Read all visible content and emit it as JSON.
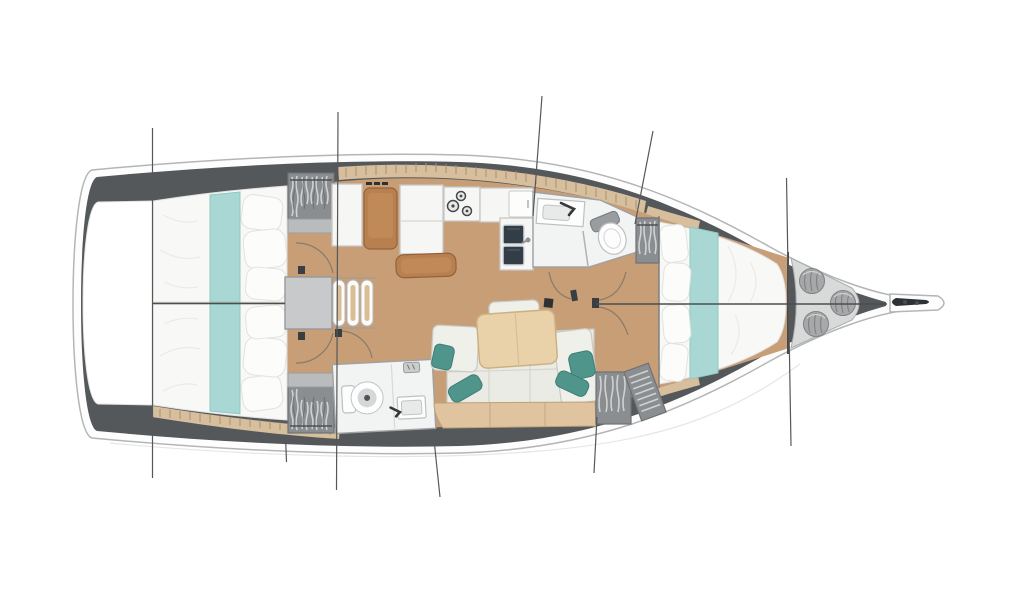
{
  "diagram": {
    "type": "yacht-interior-floor-plan",
    "orientation": "bow-right",
    "components": [
      "hull",
      "transom-platform",
      "bulwark-band",
      "deck-tick-strip",
      "aft-cabin-port",
      "aft-cabin-starboard",
      "double-berth",
      "teal-bed-runner",
      "hanging-wardrobe",
      "companionway-steps",
      "engine-box",
      "galley-cabinet",
      "nav-seat",
      "chart-table",
      "stove-burners",
      "double-sink",
      "galley-island",
      "forward-head",
      "aft-head",
      "toilet",
      "washbasin",
      "salon-table",
      "salon-settee",
      "teal-cushions",
      "settee-front-panel",
      "forward-cabin-berth",
      "forward-wardrobes",
      "mast-post",
      "sail-locker",
      "rope-coils",
      "anchor-roller",
      "section-lines",
      "centerline",
      "door-swing-arcs"
    ],
    "colors": {
      "background": "#ffffff",
      "hull_line": "#b4b6b6",
      "deck_white": "#fdfdfd",
      "bulwark": "#54585b",
      "floor": "#c89e77",
      "deck_strip": "#d7bf9e",
      "strip_tick": "#a98f6d",
      "unit_white": "#f6f6f5",
      "unit_border": "#c6c7c5",
      "wood_seat": "#b9804f",
      "wood_seat_light": "#c08a58",
      "table_wood": "#e9d2aa",
      "table_edge": "#ccb183",
      "bench_wood": "#dfc49f",
      "bed_white": "#f8f8f7",
      "bed_edge": "#e0e0de",
      "runner_teal": "#a9d8d4",
      "runner_edge": "#8ec7c2",
      "pillow_teal": "#4f958c",
      "pillow_teal_edge": "#3e7d75",
      "wardrobe": "#8b8e90",
      "wardrobe_dark": "#6f7274",
      "wardrobe_streak": "#d7d8d8",
      "steps_box": "#c7c9ca",
      "sink_dark": "#333d47",
      "locker_floor": "#d8d9d9",
      "coil": "#a6a8a9",
      "coil_edge": "#7f8183",
      "section_line": "#55585a",
      "door_arc": "#8a7a68",
      "head_white": "#f2f3f3",
      "head_border": "#9fa1a3",
      "anchor_dark": "#2f3234"
    }
  }
}
